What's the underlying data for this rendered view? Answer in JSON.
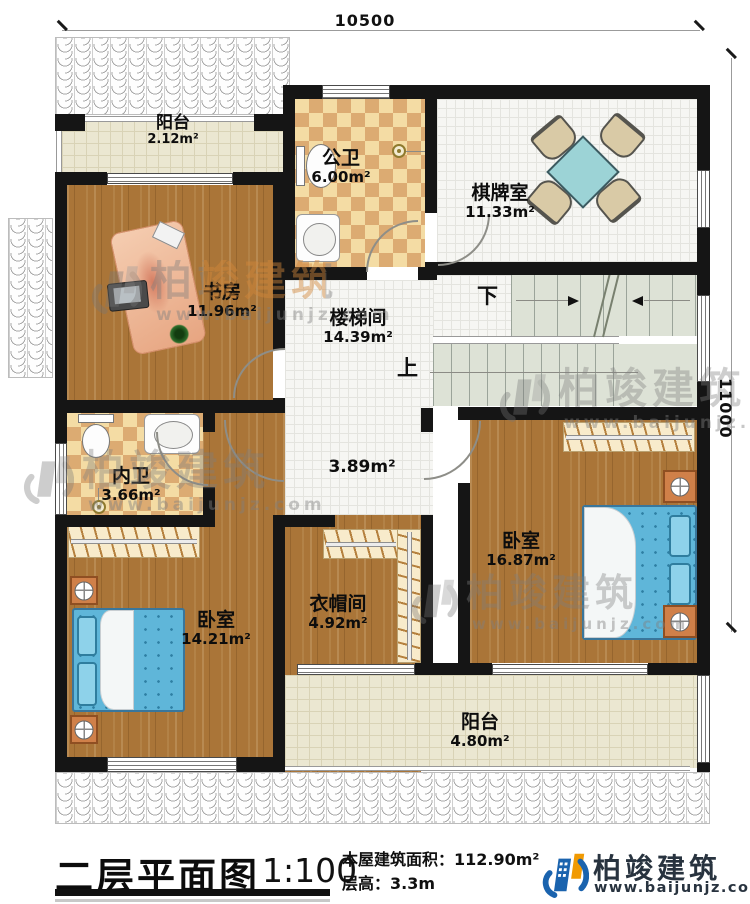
{
  "dimensions": {
    "width_label": "10500",
    "height_label": "11000"
  },
  "rooms": {
    "balcony_top": {
      "name": "阳台",
      "area": "2.12m²"
    },
    "public_bath": {
      "name": "公卫",
      "area": "6.00m²"
    },
    "game_room": {
      "name": "棋牌室",
      "area": "11.33m²"
    },
    "study": {
      "name": "书房",
      "area": "11.96m²"
    },
    "stairwell": {
      "name": "楼梯间",
      "area": "14.39m²"
    },
    "hallway": {
      "area": "3.89m²"
    },
    "inner_bath": {
      "name": "内卫",
      "area": "3.66m²"
    },
    "bedroom_right": {
      "name": "卧室",
      "area": "16.87m²"
    },
    "cloakroom": {
      "name": "衣帽间",
      "area": "4.92m²"
    },
    "bedroom_left": {
      "name": "卧室",
      "area": "14.21m²"
    },
    "balcony_bottom": {
      "name": "阳台",
      "area": "4.80m²"
    }
  },
  "stairs": {
    "up_label": "上",
    "down_label": "下"
  },
  "watermark": {
    "brand": "柏竣建筑",
    "url": "www.baijunjz.com"
  },
  "footer": {
    "title": "二层平面图",
    "scale": "1:100",
    "area_line": "本屋建筑面积：112.90m²",
    "height_line": "层高：3.3m",
    "brand": "柏竣建筑",
    "url": "www.baijunjz.com"
  },
  "colors": {
    "brand_blue": "#1a63ae",
    "brand_orange": "#f19a02",
    "wall": "#151515",
    "bed_blue": "#5fb6d9"
  }
}
